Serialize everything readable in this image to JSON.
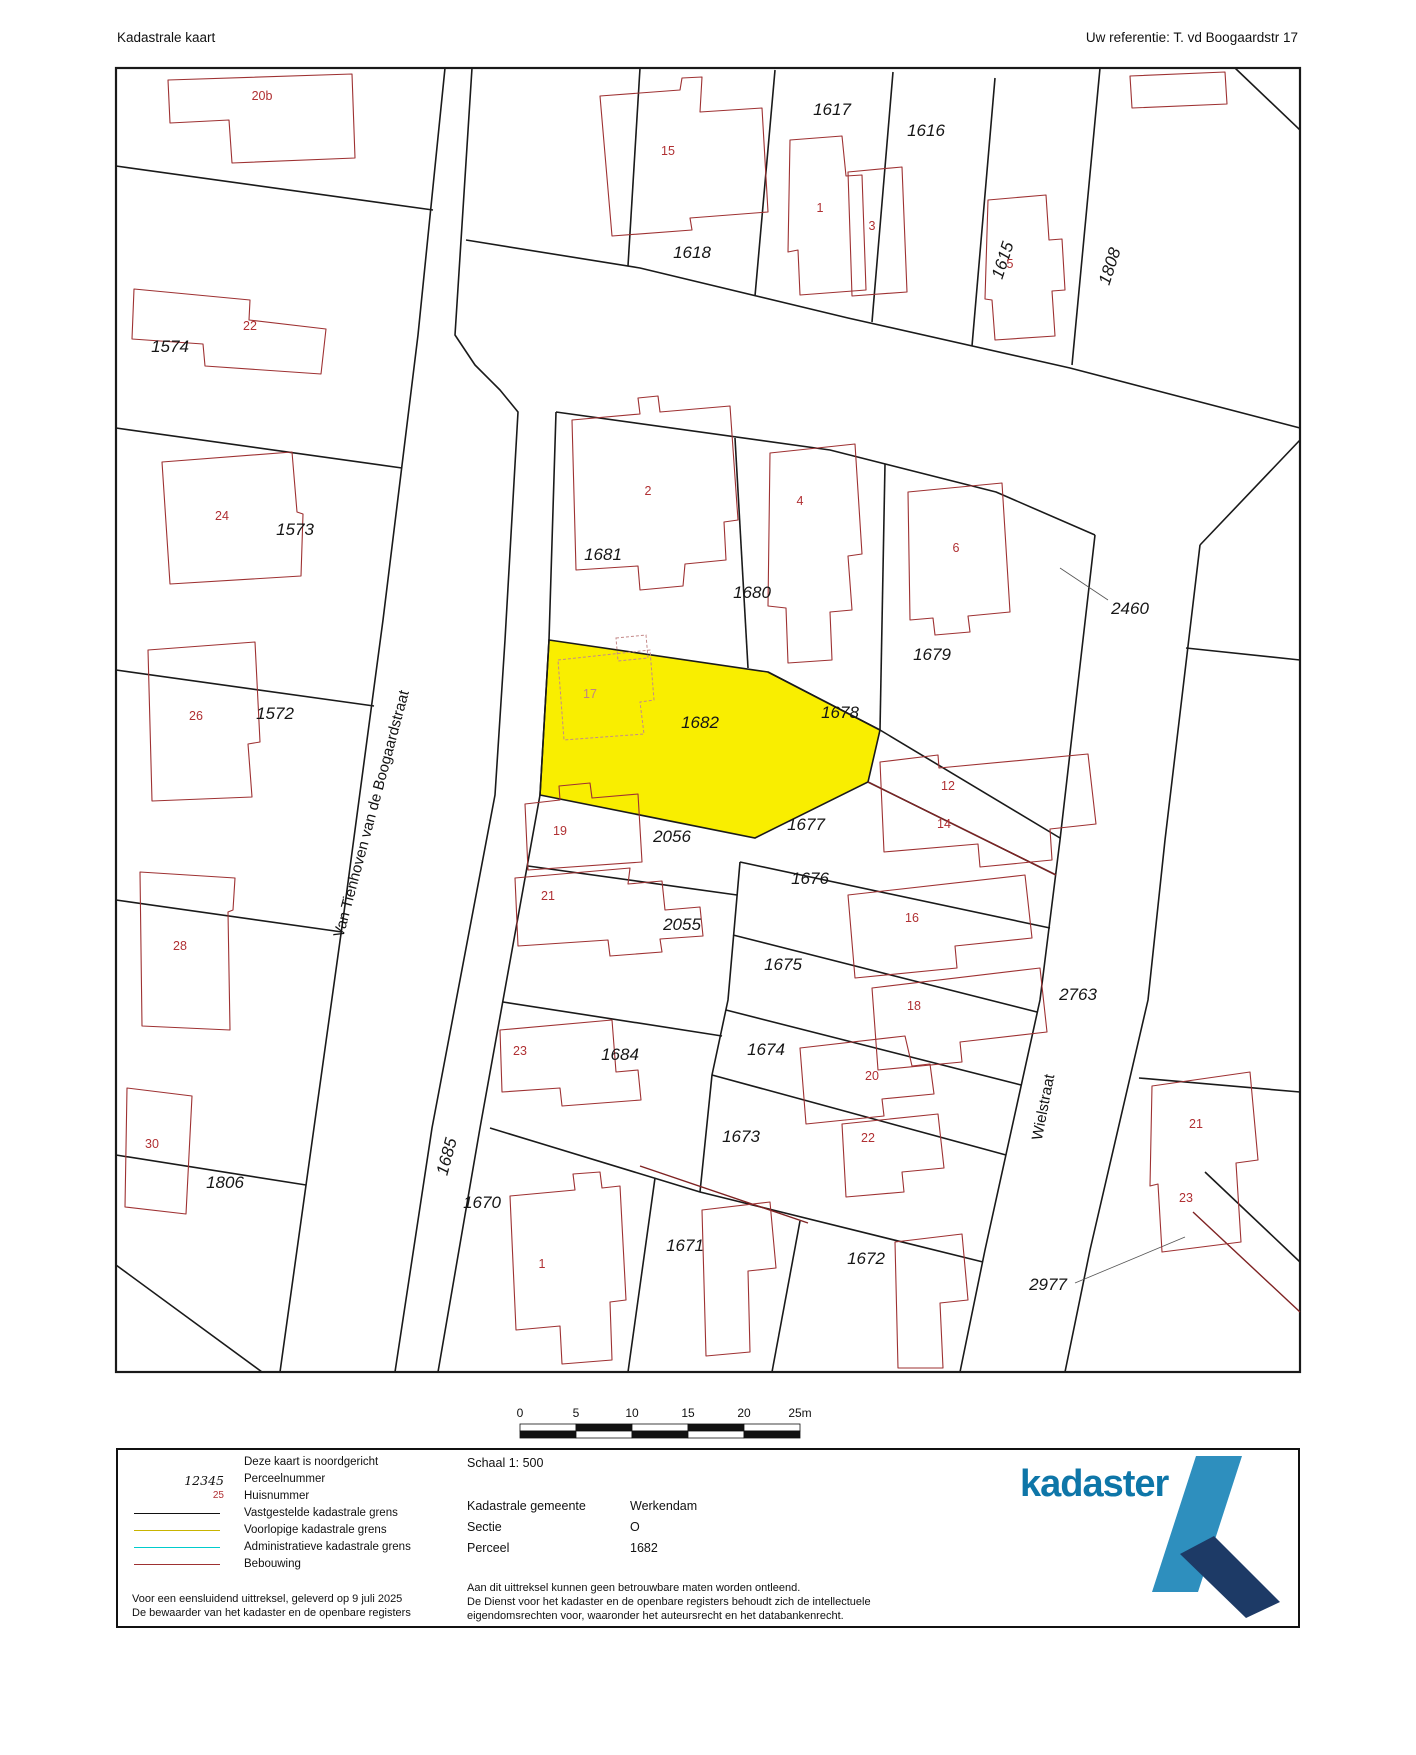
{
  "header": {
    "title": "Kadastrale kaart",
    "reference": "Uw referentie: T. vd Boogaardstr 17"
  },
  "colors": {
    "highlight": "#f9ee00",
    "building": "#9e3132",
    "house_number": "#b03033",
    "boundary": "#1a1a1a",
    "logo_blue": "#0e76a8",
    "logo_light": "#2e8fbe",
    "logo_dark": "#1d3a66",
    "voorlopige_grens": "#c8b400",
    "administratieve_grens": "#00cccc"
  },
  "map": {
    "parcel_labels": [
      {
        "text": "1574",
        "x": 170,
        "y": 352
      },
      {
        "text": "1573",
        "x": 295,
        "y": 535
      },
      {
        "text": "1572",
        "x": 275,
        "y": 719
      },
      {
        "text": "1806",
        "x": 225,
        "y": 1188
      },
      {
        "text": "1618",
        "x": 692,
        "y": 258
      },
      {
        "text": "1617",
        "x": 832,
        "y": 115
      },
      {
        "text": "1616",
        "x": 926,
        "y": 136
      },
      {
        "text": "1615",
        "x": 1008,
        "y": 262,
        "rot": -72
      },
      {
        "text": "1808",
        "x": 1115,
        "y": 268,
        "rot": -72
      },
      {
        "text": "1681",
        "x": 603,
        "y": 560
      },
      {
        "text": "1680",
        "x": 752,
        "y": 598
      },
      {
        "text": "1679",
        "x": 932,
        "y": 660
      },
      {
        "text": "2460",
        "x": 1130,
        "y": 614
      },
      {
        "text": "1682",
        "x": 700,
        "y": 728
      },
      {
        "text": "1678",
        "x": 840,
        "y": 718
      },
      {
        "text": "1677",
        "x": 806,
        "y": 830
      },
      {
        "text": "2056",
        "x": 672,
        "y": 842
      },
      {
        "text": "1676",
        "x": 810,
        "y": 884
      },
      {
        "text": "2055",
        "x": 682,
        "y": 930
      },
      {
        "text": "1675",
        "x": 783,
        "y": 970
      },
      {
        "text": "2763",
        "x": 1078,
        "y": 1000
      },
      {
        "text": "1684",
        "x": 620,
        "y": 1060
      },
      {
        "text": "1674",
        "x": 766,
        "y": 1055
      },
      {
        "text": "1673",
        "x": 741,
        "y": 1142
      },
      {
        "text": "1670",
        "x": 482,
        "y": 1208
      },
      {
        "text": "1671",
        "x": 685,
        "y": 1251
      },
      {
        "text": "1672",
        "x": 866,
        "y": 1264
      },
      {
        "text": "2977",
        "x": 1048,
        "y": 1290
      },
      {
        "text": "1685",
        "x": 452,
        "y": 1158,
        "rot": -75
      }
    ],
    "house_numbers": [
      {
        "text": "20b",
        "x": 262,
        "y": 100
      },
      {
        "text": "22",
        "x": 250,
        "y": 330
      },
      {
        "text": "24",
        "x": 222,
        "y": 520
      },
      {
        "text": "26",
        "x": 196,
        "y": 720
      },
      {
        "text": "28",
        "x": 180,
        "y": 950
      },
      {
        "text": "30",
        "x": 152,
        "y": 1148
      },
      {
        "text": "15",
        "x": 668,
        "y": 155
      },
      {
        "text": "1",
        "x": 820,
        "y": 212
      },
      {
        "text": "3",
        "x": 872,
        "y": 230
      },
      {
        "text": "5",
        "x": 1010,
        "y": 268
      },
      {
        "text": "2",
        "x": 648,
        "y": 495
      },
      {
        "text": "4",
        "x": 800,
        "y": 505
      },
      {
        "text": "6",
        "x": 956,
        "y": 552
      },
      {
        "text": "17",
        "x": 590,
        "y": 698,
        "faint": true
      },
      {
        "text": "12",
        "x": 948,
        "y": 790
      },
      {
        "text": "14",
        "x": 944,
        "y": 828
      },
      {
        "text": "19",
        "x": 560,
        "y": 835
      },
      {
        "text": "21",
        "x": 548,
        "y": 900
      },
      {
        "text": "16",
        "x": 912,
        "y": 922
      },
      {
        "text": "18",
        "x": 914,
        "y": 1010
      },
      {
        "text": "23",
        "x": 520,
        "y": 1055
      },
      {
        "text": "20",
        "x": 872,
        "y": 1080
      },
      {
        "text": "22",
        "x": 868,
        "y": 1142
      },
      {
        "text": "1",
        "x": 542,
        "y": 1268
      },
      {
        "text": "21",
        "x": 1196,
        "y": 1128
      },
      {
        "text": "23",
        "x": 1186,
        "y": 1202
      }
    ],
    "street_names": [
      {
        "text": "Van Tienhoven van de Boogaardstraat",
        "x": 376,
        "y": 815,
        "rot": -75
      },
      {
        "text": "Wielstraat",
        "x": 1048,
        "y": 1108,
        "rot": -79
      }
    ],
    "scale_bar": {
      "ticks": [
        "0",
        "5",
        "10",
        "15",
        "20",
        "25m"
      ]
    }
  },
  "legend": {
    "rows": [
      {
        "key": "",
        "label": "Deze kaart is noordgericht"
      },
      {
        "key": "12345",
        "label": "Perceelnummer"
      },
      {
        "key": "25",
        "label": "Huisnummer"
      },
      {
        "key": "",
        "label": "Vastgestelde kadastrale grens"
      },
      {
        "key": "",
        "label": "Voorlopige kadastrale grens"
      },
      {
        "key": "",
        "label": "Administratieve kadastrale grens"
      },
      {
        "key": "",
        "label": "Bebouwing"
      }
    ],
    "footnote1": "Voor een eensluidend uittreksel, geleverd op 9 juli 2025",
    "footnote2": "De bewaarder van het kadaster en de openbare registers"
  },
  "footer": {
    "schaal_label": "Schaal 1: 500",
    "gemeente_label": "Kadastrale gemeente",
    "gemeente_value": "Werkendam",
    "sectie_label": "Sectie",
    "sectie_value": "O",
    "perceel_label": "Perceel",
    "perceel_value": "1682",
    "disclaimer1": "Aan dit uittreksel kunnen geen betrouwbare maten worden ontleend.",
    "disclaimer2": "De Dienst voor het kadaster en de openbare registers behoudt zich de intellectuele",
    "disclaimer3": "eigendomsrechten voor, waaronder het auteursrecht en het databankenrecht.",
    "logo_text": "kadaster"
  }
}
